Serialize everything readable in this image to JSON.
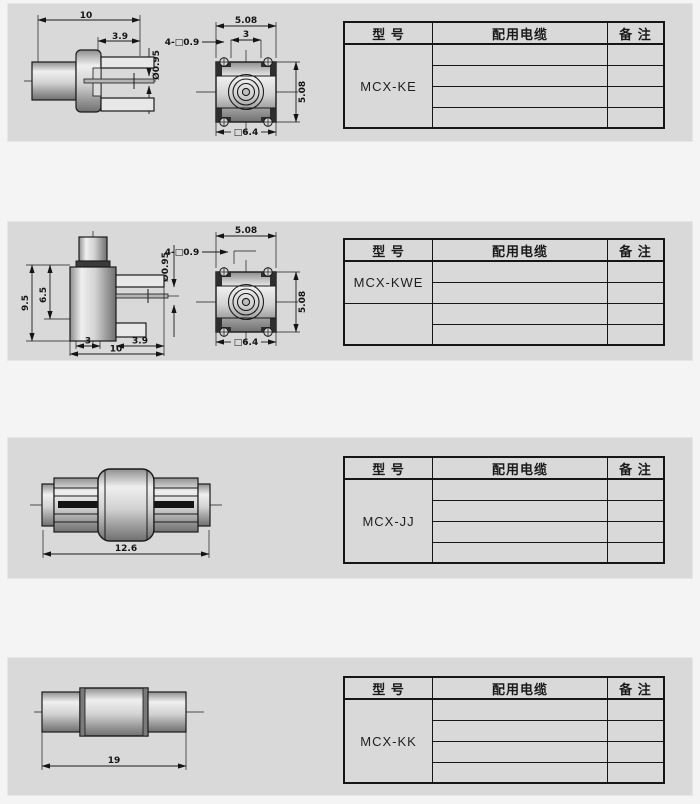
{
  "page": {
    "band_color": "#d9d9d9",
    "gap_color": "#f4f4f4",
    "line_color": "#1a1a1a"
  },
  "table_header": {
    "model": "型  号",
    "cable": "配用电缆",
    "remark": "备  注"
  },
  "sections": [
    {
      "model": "MCX-KE",
      "dims": {
        "overall": "10",
        "tab": "3.9",
        "pin": "Ø0.95",
        "pitch_top": "5.08",
        "inner": "3",
        "post": "4-□0.9",
        "pitch_side": "5.08",
        "body": "□6.4"
      }
    },
    {
      "model": "MCX-KWE",
      "dims": {
        "height": "9.5",
        "inner_height": "6.5",
        "pin": "Ø0.95",
        "pitch_top": "5.08",
        "post": "4-□0.9",
        "pitch_side": "5.08",
        "body": "□6.4",
        "foot": "3",
        "tab": "3.9",
        "overall": "10"
      }
    },
    {
      "model": "MCX-JJ",
      "dims": {
        "length": "12.6"
      }
    },
    {
      "model": "MCX-KK",
      "dims": {
        "length": "19"
      }
    }
  ]
}
